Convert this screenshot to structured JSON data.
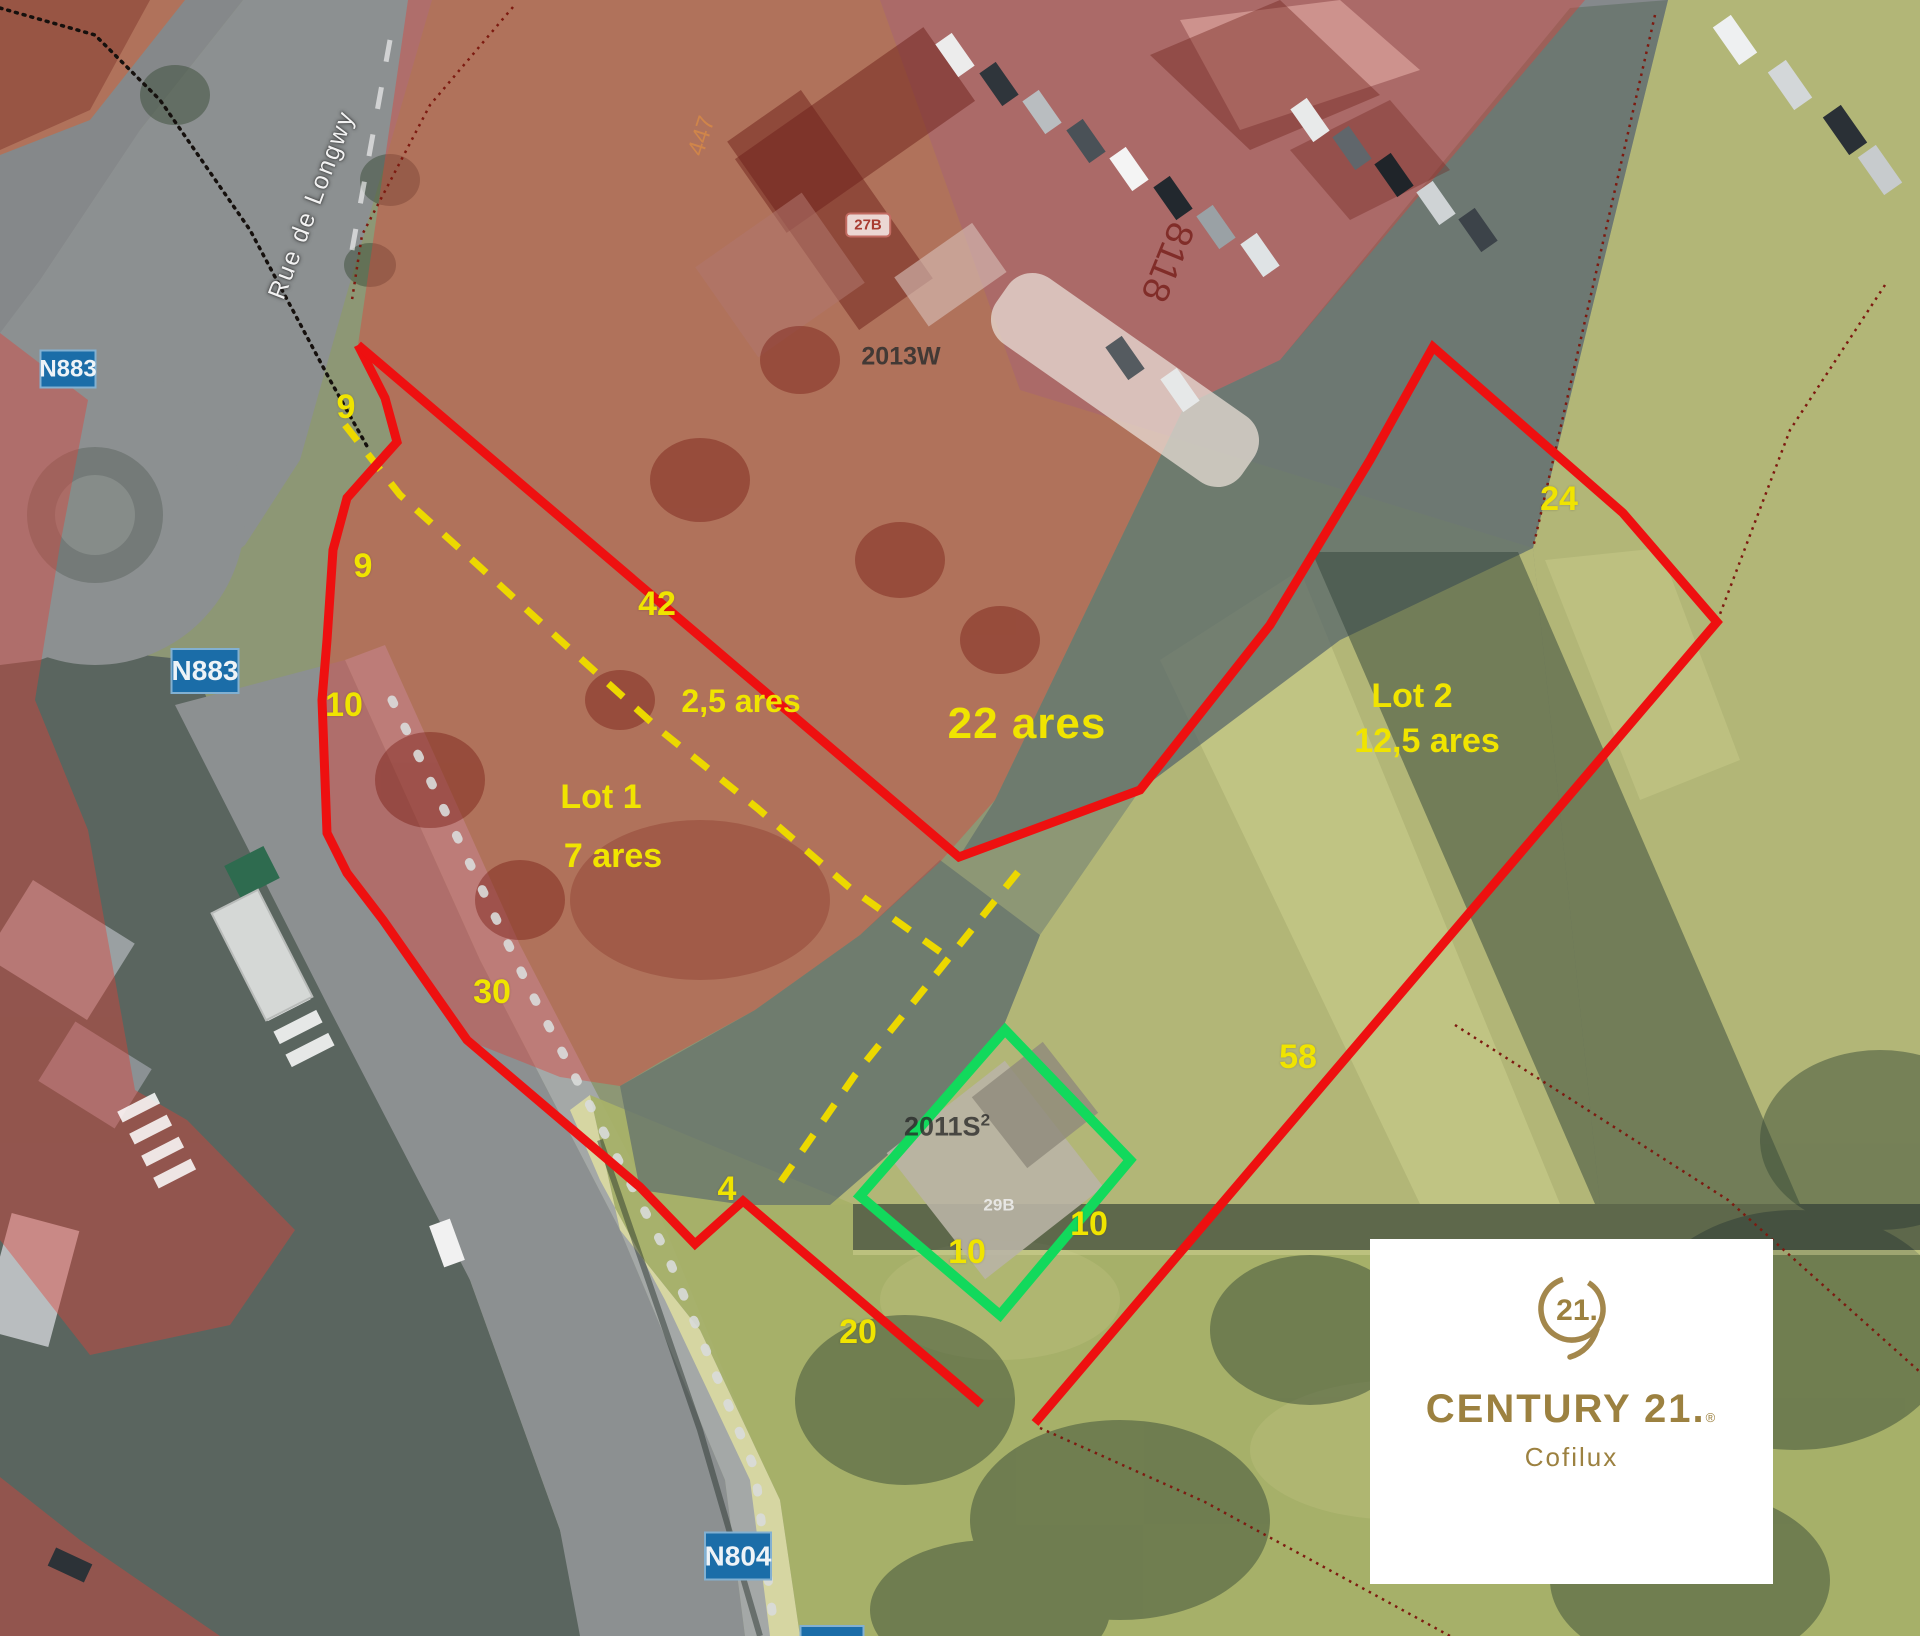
{
  "map": {
    "street": "Rue de Longwy",
    "badges": {
      "n883_top": "N883",
      "n883_mid": "N883",
      "n804": "N804"
    },
    "parcels": {
      "parcel_2013w": "2013W",
      "building_27b": "27B",
      "parcel_8118": "8118",
      "parcel_447": "447",
      "parcel_2011s": "2011S",
      "parcel_2011s_exp": "2",
      "building_29b": "29B"
    },
    "lots": {
      "lot1": {
        "name": "Lot 1",
        "area": "7 ares"
      },
      "lot2": {
        "name": "Lot 2",
        "area": "12,5 ares"
      },
      "strip_area": "2,5 ares",
      "total_area": "22 ares"
    },
    "dimensions": [
      "9",
      "9",
      "10",
      "42",
      "30",
      "4",
      "20",
      "10",
      "10",
      "58",
      "24"
    ]
  },
  "logo": {
    "brand": "CENTURY 21.",
    "registered": "®",
    "agency": "Cofilux",
    "seal": "21."
  },
  "colors": {
    "boundary_red": "#ee1010",
    "lot_green": "#12d95c",
    "dash_yellow": "#ecd800",
    "label_yellow": "#f0e400",
    "badge_blue": "#1b6da8",
    "overlay_red": "#e14036",
    "logo_gold": "#9c8140"
  }
}
